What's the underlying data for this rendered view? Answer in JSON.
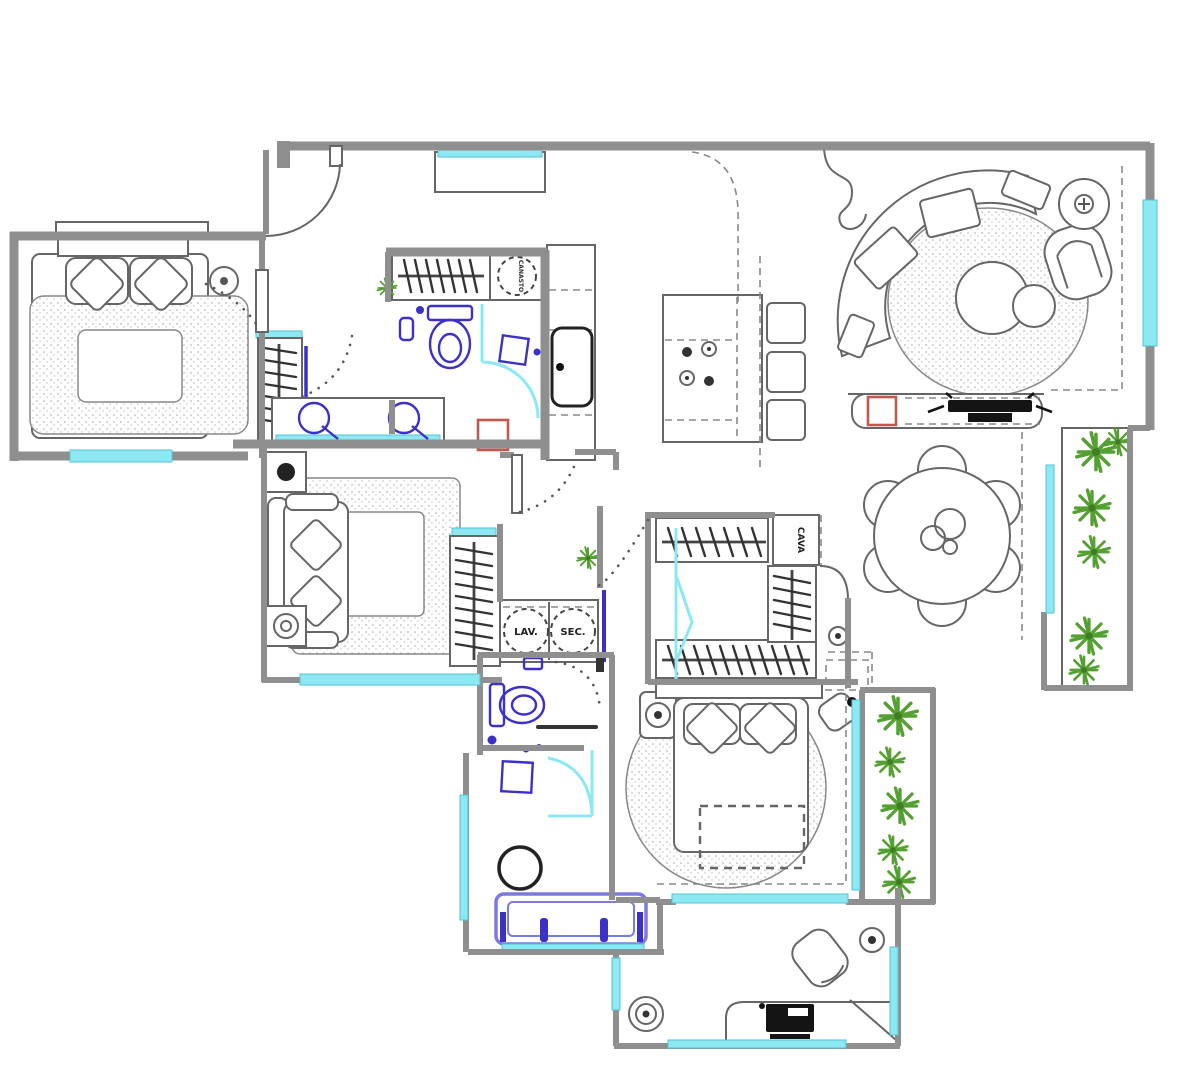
{
  "plan": {
    "type": "apartment-floor-plan",
    "labels": {
      "washer": "LAV.",
      "dryer": "SEC.",
      "cava": "CAVA",
      "basket": "CANASTO"
    },
    "colors": {
      "background": "#ffffff",
      "walls": "#8f8f8f",
      "furniture_lines": "#666666",
      "windows_glass": "#8ce8f2",
      "plumbing_fixtures": "#3b31c8",
      "bathtub": "#7a7ae0",
      "plants": "#55a032",
      "accent_red": "#c0594f",
      "electronics_black": "#141414"
    }
  }
}
